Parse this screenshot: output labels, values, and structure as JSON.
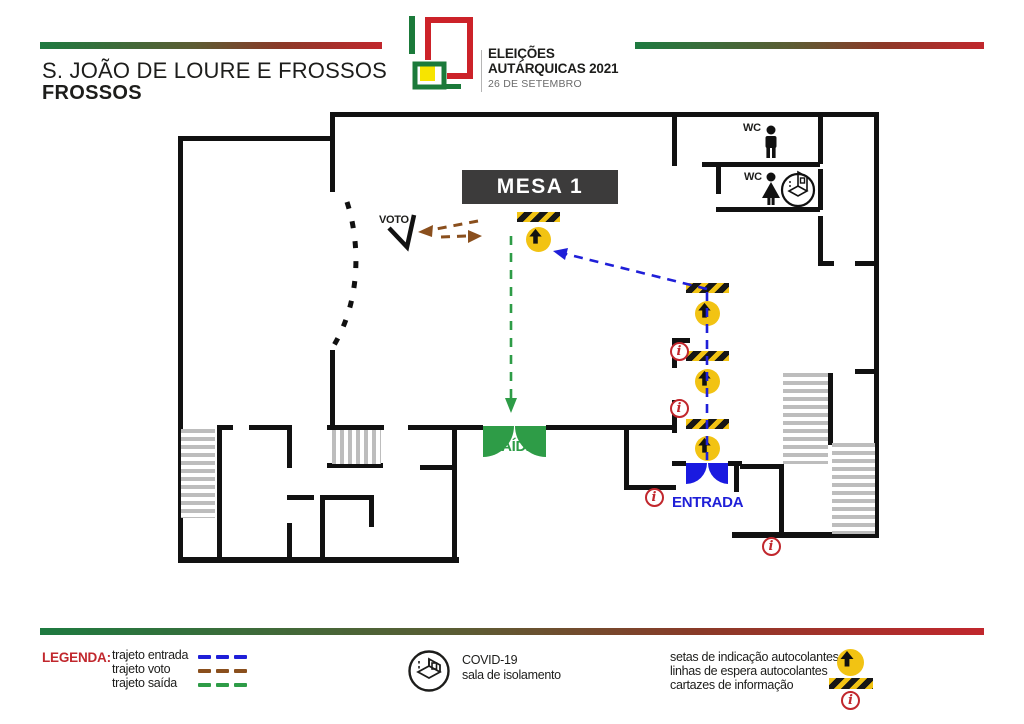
{
  "header": {
    "title_line1": "S. JOÃO DE LOURE E FROSSOS",
    "title_line2": "FROSSOS"
  },
  "logo": {
    "line1": "ELEIÇÕES",
    "line2": "AUTÁRQUICAS 2021",
    "line3": "26 DE SETEMBRO"
  },
  "plan": {
    "mesa_label": "MESA 1",
    "voto_label": "VOTO",
    "wc_label": "WC",
    "saida_label": "SAÍDA",
    "entrada_label": "ENTRADA",
    "info_glyph": "i"
  },
  "legend": {
    "title": "LEGENDA:",
    "routes": [
      {
        "label": "trajeto entrada",
        "color": "#1f1fd8"
      },
      {
        "label": "trajeto voto",
        "color": "#8a4f1d"
      },
      {
        "label": "trajeto saída",
        "color": "#2e9c47"
      }
    ],
    "covid_line1": "COVID-19",
    "covid_line2": "sala de isolamento",
    "items": [
      {
        "label": "setas de indicação autocolantes"
      },
      {
        "label": "linhas de espera autocolantes"
      },
      {
        "label": "cartazes de informação"
      }
    ]
  },
  "colors": {
    "entrance_blue": "#1f1fd8",
    "vote_brown": "#8a4f1d",
    "exit_green": "#2e9c47",
    "info_red": "#c1272d",
    "sign_yellow": "#f2c313",
    "mesa_dark": "#3c3b3b",
    "wall_black": "#111111"
  }
}
